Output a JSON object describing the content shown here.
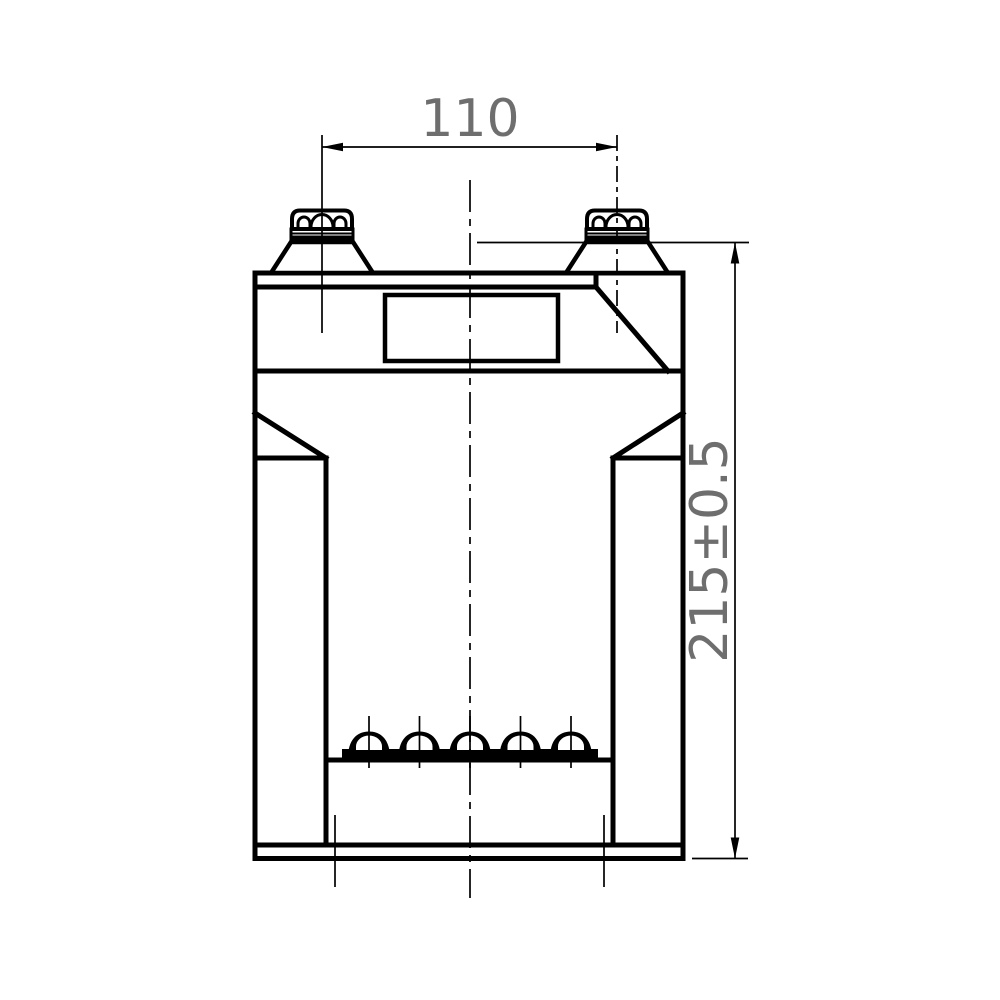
{
  "drawing": {
    "kind": "engineering-dimension-drawing",
    "background": "#ffffff",
    "line_color": "#000000",
    "dim_text_color": "#6e6e6e",
    "dim_width": {
      "label": "110"
    },
    "dim_height": {
      "label": "215±0.5"
    }
  }
}
